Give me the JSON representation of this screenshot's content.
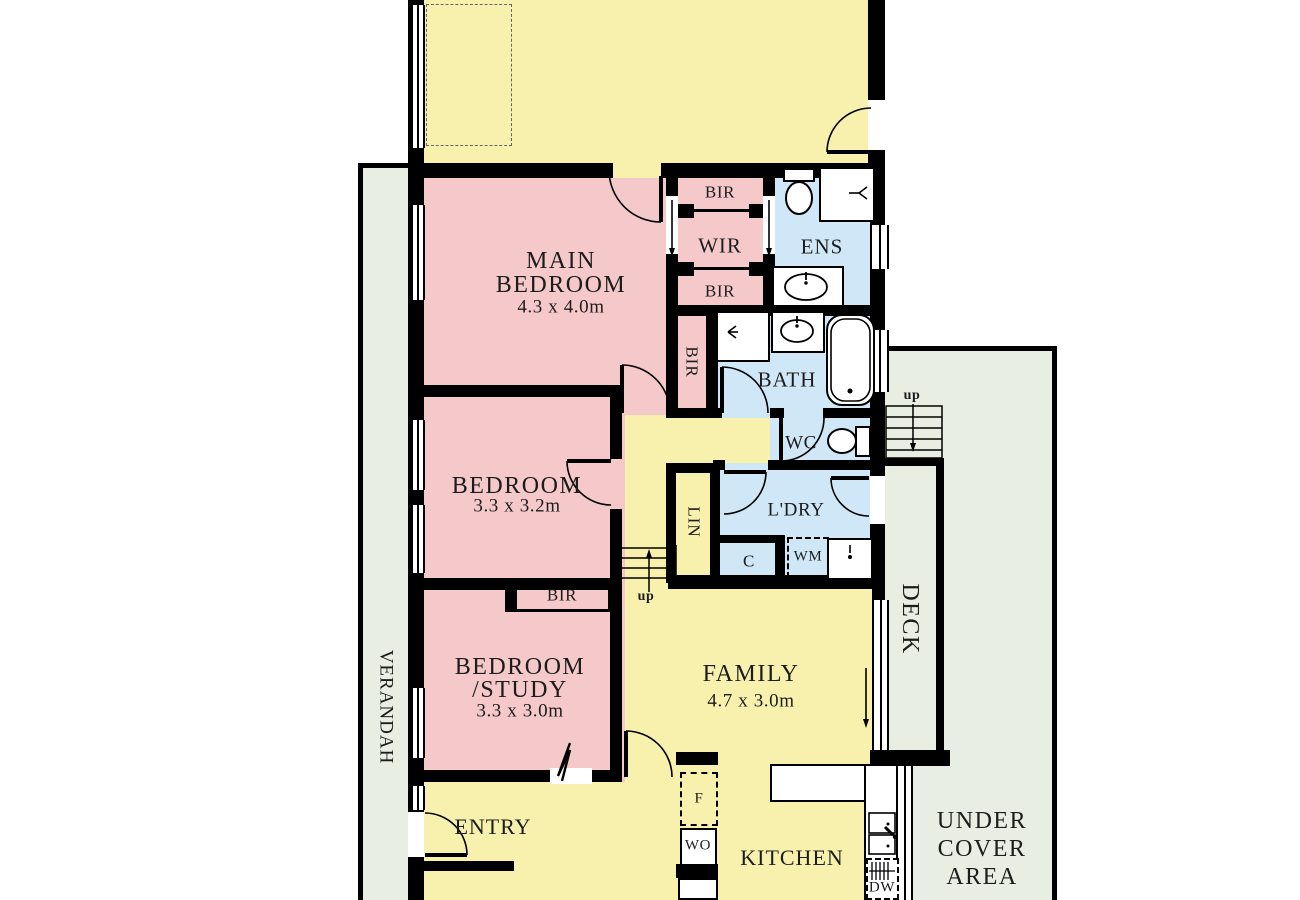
{
  "plan": {
    "rooms": {
      "upper_room": {
        "note": ""
      },
      "main_bedroom": {
        "line1": "MAIN",
        "line2": "BEDROOM",
        "dims": "4.3 x 4.0m"
      },
      "bedroom": {
        "name": "BEDROOM",
        "dims": "3.3 x 3.2m"
      },
      "bedroom_study": {
        "line1": "BEDROOM",
        "line2": "/STUDY",
        "dims": "3.3 x 3.0m"
      },
      "family": {
        "name": "FAMILY",
        "dims": "4.7 x 3.0m"
      },
      "entry": {
        "name": "ENTRY"
      },
      "kitchen": {
        "name": "KITCHEN"
      },
      "wir": {
        "name": "WIR"
      },
      "ens": {
        "name": "ENS"
      },
      "bath": {
        "name": "BATH"
      },
      "wc": {
        "name": "WC"
      },
      "laundry": {
        "name": "L'DRY"
      },
      "verandah": {
        "name": "VERANDAH"
      },
      "deck": {
        "name": "DECK"
      },
      "under_cover_area": {
        "line1": "UNDER",
        "line2": "COVER",
        "line3": "AREA"
      }
    },
    "storage": {
      "bir": "BIR",
      "lin": "LIN",
      "cupboard": "C"
    },
    "appliances": {
      "wm": "WM",
      "fridge": "F",
      "wall_oven": "WO",
      "dishwasher": "DW"
    },
    "stairs": {
      "up": "up"
    },
    "colors": {
      "living": "#f8f1ae",
      "bedroom": "#f5c9ca",
      "wet": "#cfe7f7",
      "outdoor": "#e8eee1",
      "wall": "#000000",
      "text": "#1c1c1c"
    }
  }
}
